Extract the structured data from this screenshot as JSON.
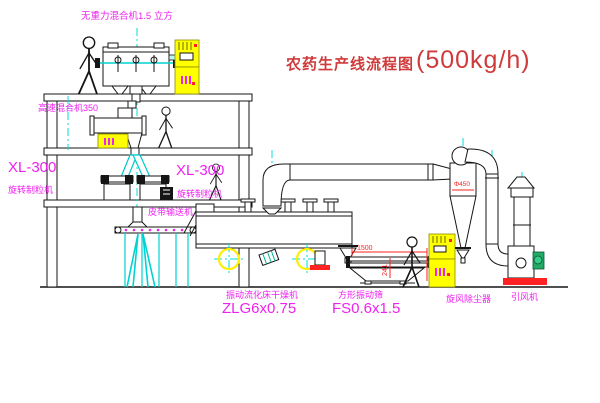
{
  "title": {
    "text": "农药生产线流程图",
    "capacity": "(500kg/h)"
  },
  "equipment": {
    "gravity_mixer": {
      "label": "无重力混合机1.5 立方"
    },
    "high_speed_mixer": {
      "label": "高速混合机350"
    },
    "granulator_left": {
      "model": "XL-300",
      "name": "旋转制粒机"
    },
    "granulator_right": {
      "model": "XL-300",
      "name": "旋转制粒机"
    },
    "belt_conveyor": {
      "label": "皮带输送机"
    },
    "fluid_bed_dryer": {
      "name": "振动流化床干燥机",
      "model": "ZLG6x0.75"
    },
    "vibrating_sieve": {
      "name": "方形振动筛",
      "model": "FS0.6x1.5"
    },
    "cyclone": {
      "label": "旋风除尘器",
      "diameter": "Φ450"
    },
    "draft_fan": {
      "label": "引风机"
    }
  },
  "dimensions": {
    "sieve_length": "1500",
    "sieve_height": "241"
  },
  "colors": {
    "line": "#151515",
    "centerline": "#00dcdc",
    "label": "#ee22ee",
    "title": "#cf3b3b",
    "cabinet": "#ffff00",
    "alert": "#ff2222"
  }
}
